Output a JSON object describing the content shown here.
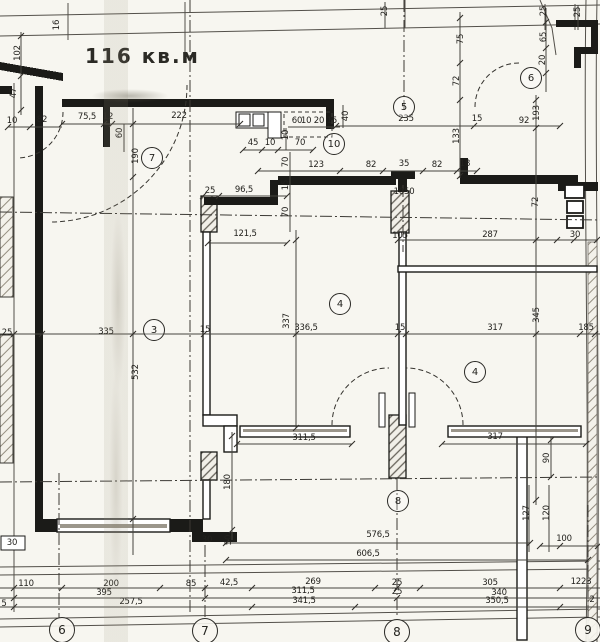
{
  "title": {
    "text": "116 кв.м"
  },
  "colors": {
    "paper": "#f7f6f0",
    "ink": "#1b1b18",
    "dim_line": "#46443e",
    "text": "#23221e"
  },
  "room_markers": [
    {
      "label": "7",
      "x": 152,
      "y": 158
    },
    {
      "label": "10",
      "x": 334,
      "y": 144
    },
    {
      "label": "5",
      "x": 404,
      "y": 107
    },
    {
      "label": "6",
      "x": 531,
      "y": 78
    },
    {
      "label": "3",
      "x": 154,
      "y": 330
    },
    {
      "label": "4",
      "x": 340,
      "y": 304
    },
    {
      "label": "4",
      "x": 475,
      "y": 372
    },
    {
      "label": "8",
      "x": 398,
      "y": 501
    }
  ],
  "axis_bubbles": [
    {
      "label": "6",
      "x": 62,
      "y": 630
    },
    {
      "label": "7",
      "x": 205,
      "y": 631
    },
    {
      "label": "8",
      "x": 397,
      "y": 632
    },
    {
      "label": "9",
      "x": 588,
      "y": 630
    }
  ],
  "dimensions": [
    {
      "text": "16",
      "x": 57,
      "y": 25,
      "rot": true
    },
    {
      "text": "102",
      "x": 18,
      "y": 53,
      "rot": true
    },
    {
      "text": "47",
      "x": 14,
      "y": 93,
      "rot": true
    },
    {
      "text": "10",
      "x": 12,
      "y": 121
    },
    {
      "text": "82",
      "x": 42,
      "y": 120
    },
    {
      "text": "75,5",
      "x": 87,
      "y": 117
    },
    {
      "text": "12",
      "x": 108,
      "y": 117
    },
    {
      "text": "60",
      "x": 120,
      "y": 133,
      "rot": true
    },
    {
      "text": "222",
      "x": 179,
      "y": 116
    },
    {
      "text": "190",
      "x": 136,
      "y": 156,
      "rot": true
    },
    {
      "text": "25",
      "x": 385,
      "y": 11,
      "rot": true
    },
    {
      "text": "60",
      "x": 297,
      "y": 121
    },
    {
      "text": "10 20 15",
      "x": 319,
      "y": 121
    },
    {
      "text": "40",
      "x": 346,
      "y": 116,
      "rot": true
    },
    {
      "text": "45",
      "x": 253,
      "y": 143
    },
    {
      "text": "10",
      "x": 270,
      "y": 143
    },
    {
      "text": "70",
      "x": 300,
      "y": 143
    },
    {
      "text": "10",
      "x": 286,
      "y": 135,
      "rot": true
    },
    {
      "text": "70",
      "x": 286,
      "y": 162,
      "rot": true
    },
    {
      "text": "123",
      "x": 316,
      "y": 165
    },
    {
      "text": "82",
      "x": 371,
      "y": 165
    },
    {
      "text": "35",
      "x": 404,
      "y": 164
    },
    {
      "text": "82",
      "x": 437,
      "y": 165
    },
    {
      "text": "18",
      "x": 465,
      "y": 164
    },
    {
      "text": "235",
      "x": 406,
      "y": 119
    },
    {
      "text": "75",
      "x": 461,
      "y": 39,
      "rot": true
    },
    {
      "text": "72",
      "x": 457,
      "y": 81,
      "rot": true
    },
    {
      "text": "25",
      "x": 544,
      "y": 11,
      "rot": true
    },
    {
      "text": "25",
      "x": 578,
      "y": 12,
      "rot": true
    },
    {
      "text": "65",
      "x": 544,
      "y": 37,
      "rot": true
    },
    {
      "text": "20",
      "x": 543,
      "y": 60,
      "rot": true
    },
    {
      "text": "193",
      "x": 537,
      "y": 113,
      "rot": true
    },
    {
      "text": "92",
      "x": 524,
      "y": 121
    },
    {
      "text": "15",
      "x": 477,
      "y": 119
    },
    {
      "text": "133",
      "x": 457,
      "y": 136,
      "rot": true
    },
    {
      "text": "15",
      "x": 286,
      "y": 185,
      "rot": true
    },
    {
      "text": "70",
      "x": 286,
      "y": 212,
      "rot": true
    },
    {
      "text": "25",
      "x": 210,
      "y": 191
    },
    {
      "text": "96,5",
      "x": 244,
      "y": 190
    },
    {
      "text": "121,5",
      "x": 245,
      "y": 234
    },
    {
      "text": "1050",
      "x": 404,
      "y": 192
    },
    {
      "text": "105",
      "x": 400,
      "y": 236
    },
    {
      "text": "287",
      "x": 490,
      "y": 235
    },
    {
      "text": "30",
      "x": 575,
      "y": 235
    },
    {
      "text": "72",
      "x": 536,
      "y": 202,
      "rot": true
    },
    {
      "text": "337",
      "x": 287,
      "y": 321,
      "rot": true
    },
    {
      "text": "25",
      "x": 7,
      "y": 333
    },
    {
      "text": "335",
      "x": 106,
      "y": 332
    },
    {
      "text": "15",
      "x": 205,
      "y": 330
    },
    {
      "text": "336,5",
      "x": 306,
      "y": 328
    },
    {
      "text": "15",
      "x": 400,
      "y": 328
    },
    {
      "text": "317",
      "x": 495,
      "y": 328
    },
    {
      "text": "185",
      "x": 586,
      "y": 328
    },
    {
      "text": "532",
      "x": 136,
      "y": 372,
      "rot": true
    },
    {
      "text": "345",
      "x": 537,
      "y": 315,
      "rot": true
    },
    {
      "text": "311,5",
      "x": 304,
      "y": 438
    },
    {
      "text": "317",
      "x": 495,
      "y": 437
    },
    {
      "text": "90",
      "x": 547,
      "y": 458,
      "rot": true
    },
    {
      "text": "180",
      "x": 228,
      "y": 482,
      "rot": true
    },
    {
      "text": "30",
      "x": 207,
      "y": 540
    },
    {
      "text": "50",
      "x": 229,
      "y": 540,
      "rot": true
    },
    {
      "text": "30",
      "x": 12,
      "y": 543
    },
    {
      "text": "576,5",
      "x": 378,
      "y": 535
    },
    {
      "text": "606,5",
      "x": 368,
      "y": 554
    },
    {
      "text": "127",
      "x": 527,
      "y": 513,
      "rot": true
    },
    {
      "text": "120",
      "x": 547,
      "y": 513,
      "rot": true
    },
    {
      "text": "100",
      "x": 564,
      "y": 539
    },
    {
      "text": "110",
      "x": 26,
      "y": 584
    },
    {
      "text": "200",
      "x": 111,
      "y": 584
    },
    {
      "text": "85",
      "x": 191,
      "y": 584
    },
    {
      "text": "42,5",
      "x": 229,
      "y": 583
    },
    {
      "text": "269",
      "x": 313,
      "y": 582
    },
    {
      "text": "25",
      "x": 397,
      "y": 583
    },
    {
      "text": "305",
      "x": 490,
      "y": 583
    },
    {
      "text": "1223",
      "x": 581,
      "y": 582
    },
    {
      "text": "395",
      "x": 104,
      "y": 593
    },
    {
      "text": "311,5",
      "x": 303,
      "y": 591
    },
    {
      "text": "25",
      "x": 397,
      "y": 592
    },
    {
      "text": "340",
      "x": 499,
      "y": 593
    },
    {
      "text": "257,5",
      "x": 131,
      "y": 602
    },
    {
      "text": "341,5",
      "x": 304,
      "y": 601
    },
    {
      "text": "350,5",
      "x": 497,
      "y": 601
    },
    {
      "text": "2",
      "x": 592,
      "y": 600
    },
    {
      "text": "5",
      "x": 4,
      "y": 604
    }
  ]
}
